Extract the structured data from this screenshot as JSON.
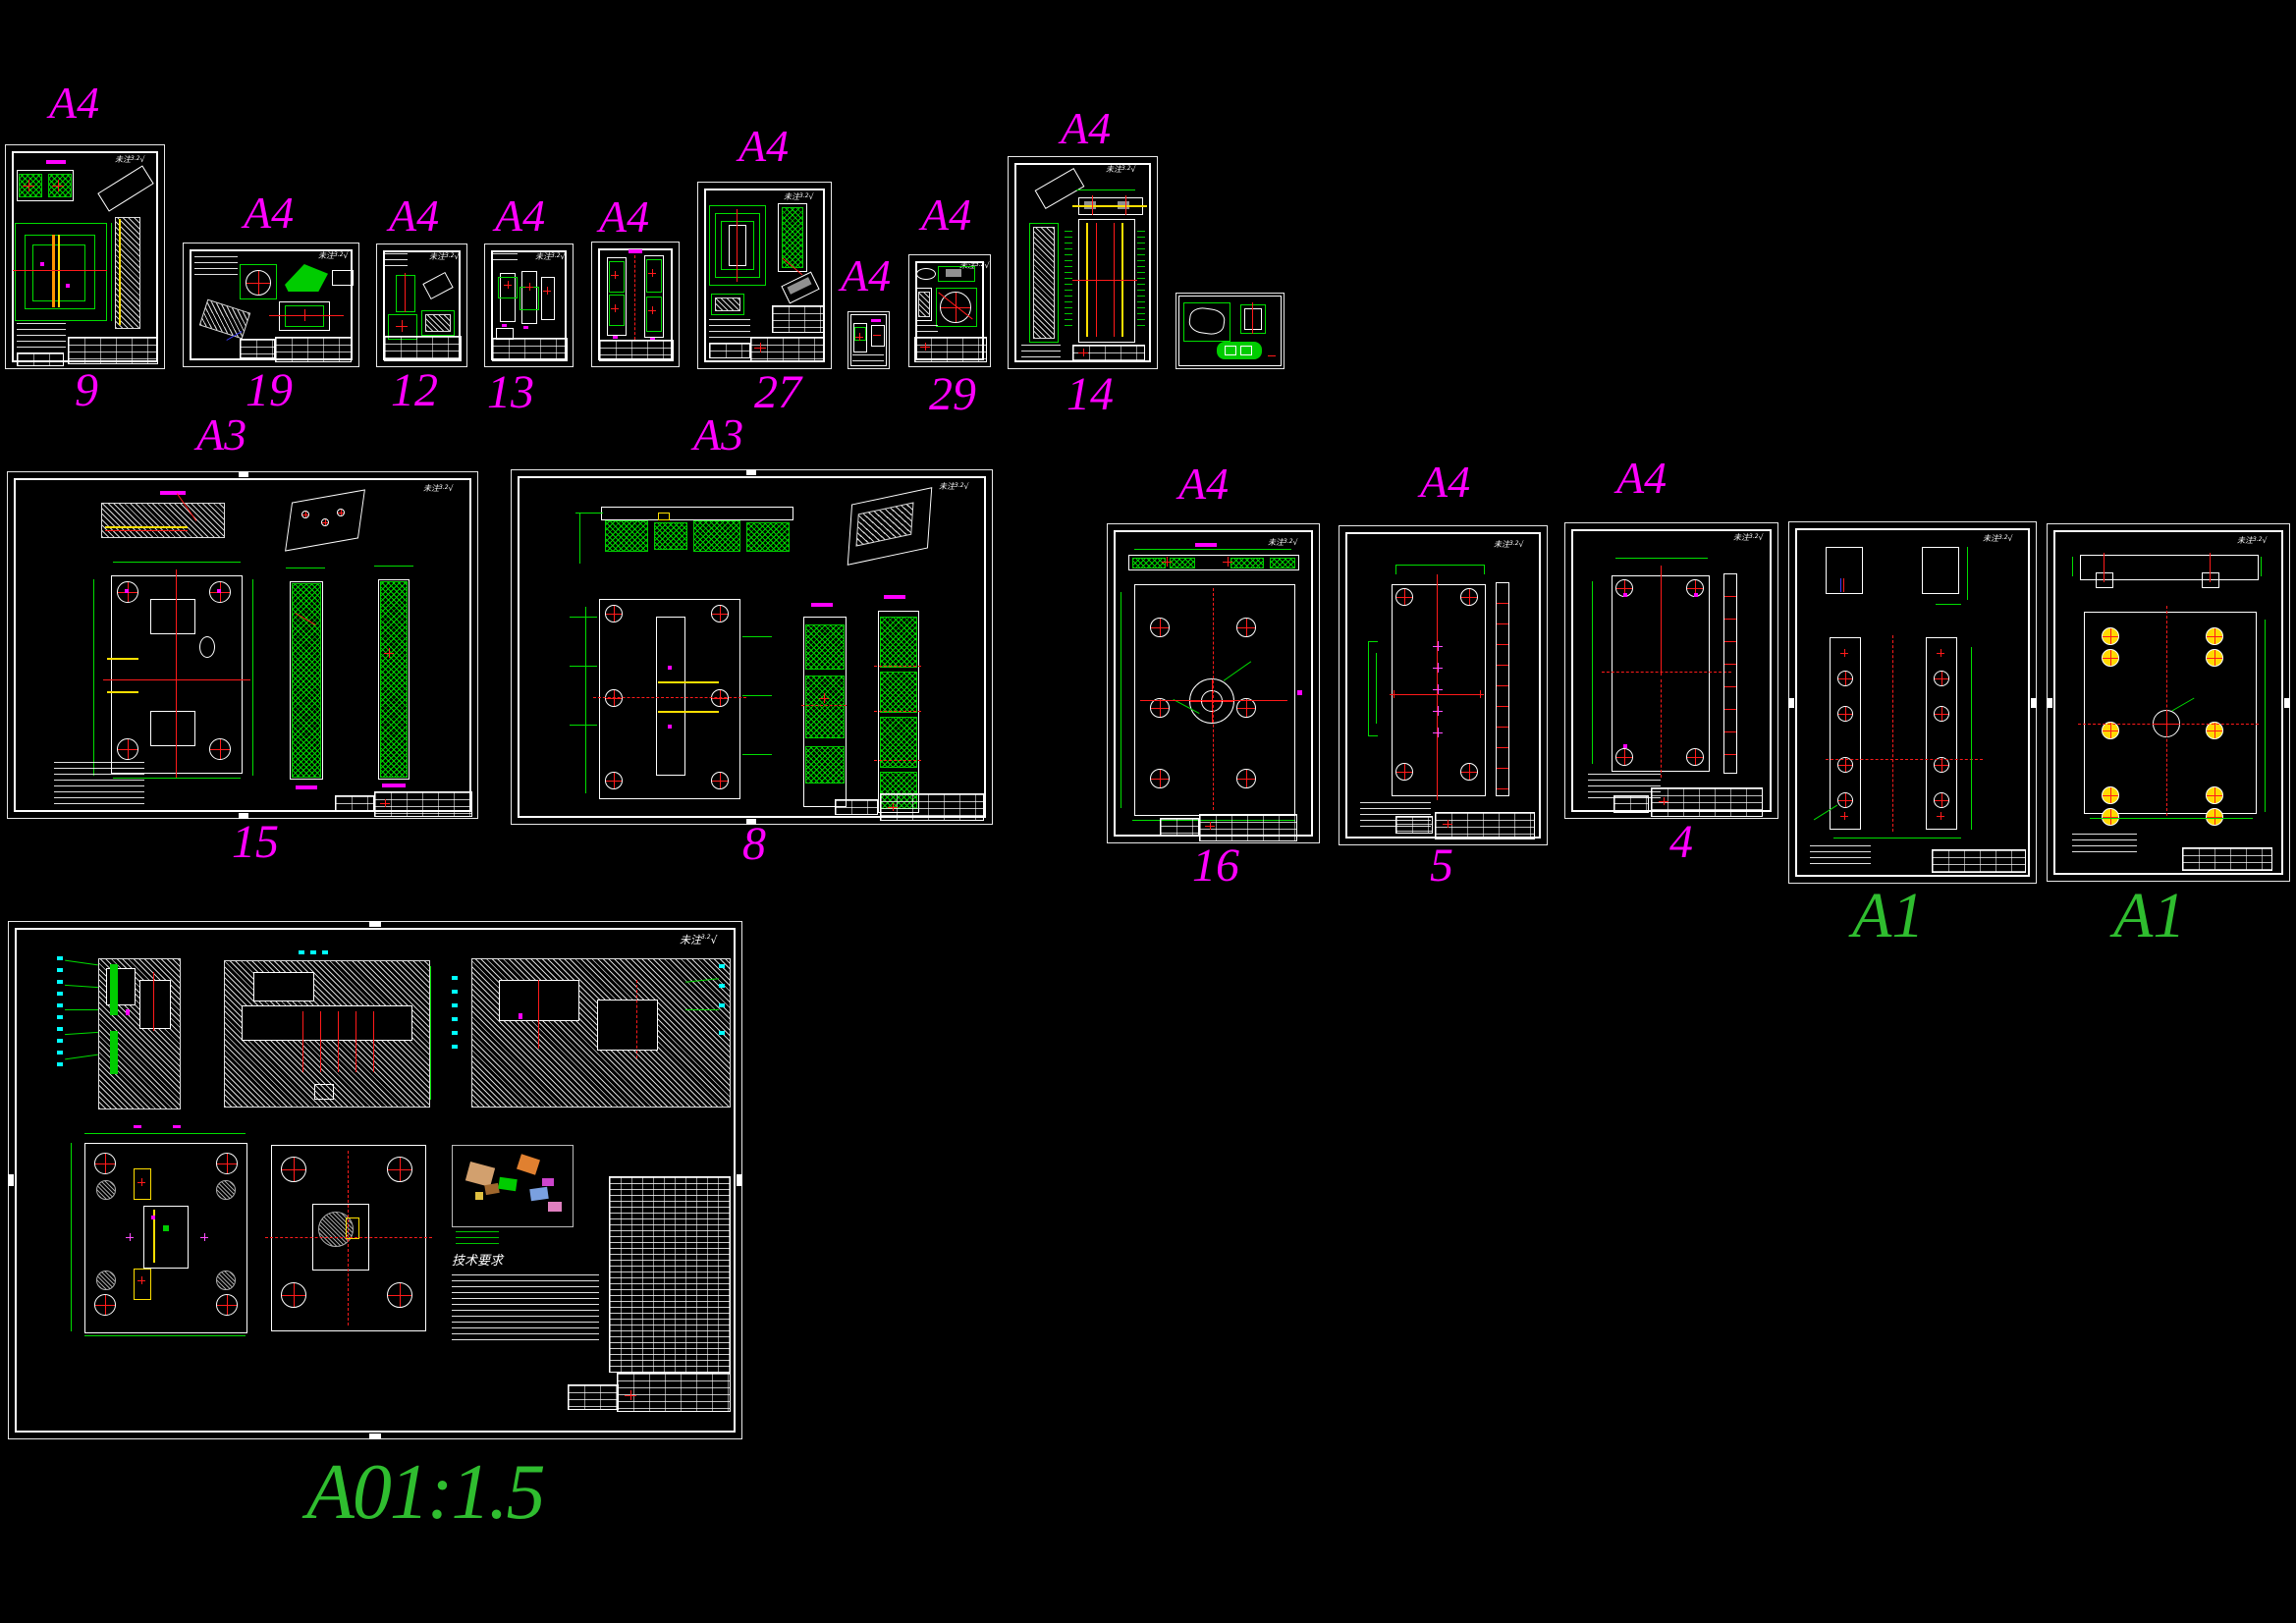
{
  "app": {
    "description": "CAD drawing sheet layout preview",
    "background": "#000000"
  },
  "colors": {
    "sheet_line": "#ffffff",
    "cad_green": "#00dd00",
    "cad_red": "#ff1a1a",
    "cad_yellow": "#ffdf00",
    "cad_orange": "#ff9500",
    "cad_cyan": "#00ffff",
    "cad_blue": "#3a3aff",
    "cad_gray": "#909090",
    "label_magenta": "#ff00ff",
    "label_green": "#2fbd2f"
  },
  "annotations": {
    "surface_note": "未注",
    "surface_value": "3.2",
    "surface_check": "√",
    "tech_requirements_heading": "技术要求"
  },
  "sheets": [
    {
      "name": "sheet-9",
      "paper": "A4",
      "number": "9"
    },
    {
      "name": "sheet-19",
      "paper": "A4",
      "number": "19"
    },
    {
      "name": "sheet-12",
      "paper": "A4",
      "number": "12"
    },
    {
      "name": "sheet-13",
      "paper": "A4",
      "number": "13"
    },
    {
      "name": "sheet-guide",
      "paper": "A4",
      "number": ""
    },
    {
      "name": "sheet-27",
      "paper": "A4",
      "number": "27"
    },
    {
      "name": "sheet-small",
      "paper": "A4",
      "number": ""
    },
    {
      "name": "sheet-29",
      "paper": "A4",
      "number": "29"
    },
    {
      "name": "sheet-14",
      "paper": "A4",
      "number": "14"
    },
    {
      "name": "sheet-lever",
      "paper": "",
      "number": ""
    },
    {
      "name": "sheet-15",
      "paper": "A3",
      "number": "15"
    },
    {
      "name": "sheet-8",
      "paper": "A3",
      "number": "8"
    },
    {
      "name": "sheet-16",
      "paper": "A4",
      "number": "16"
    },
    {
      "name": "sheet-5",
      "paper": "A4",
      "number": "5"
    },
    {
      "name": "sheet-4",
      "paper": "A4",
      "number": "4"
    },
    {
      "name": "sheet-a1-left",
      "paper": "A1",
      "number": ""
    },
    {
      "name": "sheet-a1-right",
      "paper": "A1",
      "number": ""
    },
    {
      "name": "sheet-assembly",
      "paper": "",
      "number": "",
      "scale_label": "A01:1.5"
    }
  ]
}
